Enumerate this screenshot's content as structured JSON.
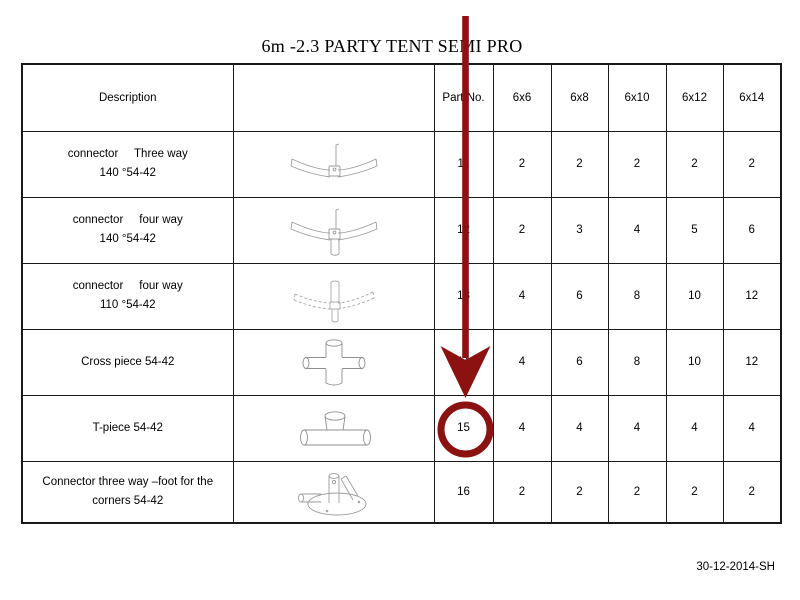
{
  "page": {
    "title": "6m -2.3 PARTY TENT SEMI PRO",
    "footer_code": "30-12-2014-SH"
  },
  "annotation": {
    "arrow_color": "#8c1212",
    "arrow_target": "Part No. column",
    "circled_value": "15"
  },
  "table": {
    "headers": {
      "description": "Description",
      "image": "",
      "part_no": "Part No.",
      "sizes": [
        "6x6",
        "6x8",
        "6x10",
        "6x12",
        "6x14"
      ]
    },
    "rows": [
      {
        "description_line1": "connector     Three way",
        "description_line2": "140 °54-42",
        "image_name": "three-way-connector-140-icon",
        "part_no": "11",
        "quantities": [
          "2",
          "2",
          "2",
          "2",
          "2"
        ]
      },
      {
        "description_line1": "connector     four way",
        "description_line2": "140 °54-42",
        "image_name": "four-way-connector-140-icon",
        "part_no": "12",
        "quantities": [
          "2",
          "3",
          "4",
          "5",
          "6"
        ]
      },
      {
        "description_line1": "connector     four way",
        "description_line2": "110 °54-42",
        "image_name": "four-way-connector-110-icon",
        "part_no": "13",
        "quantities": [
          "4",
          "6",
          "8",
          "10",
          "12"
        ]
      },
      {
        "description_line1": "Cross piece 54-42",
        "description_line2": "",
        "image_name": "cross-piece-icon",
        "part_no": "14",
        "quantities": [
          "4",
          "6",
          "8",
          "10",
          "12"
        ]
      },
      {
        "description_line1": "T-piece 54-42",
        "description_line2": "",
        "image_name": "t-piece-icon",
        "part_no": "15",
        "quantities": [
          "4",
          "4",
          "4",
          "4",
          "4"
        ]
      },
      {
        "description_line1": "Connector three way –foot for the",
        "description_line2": "corners 54-42",
        "image_name": "corner-foot-connector-icon",
        "part_no": "16",
        "quantities": [
          "2",
          "2",
          "2",
          "2",
          "2"
        ]
      }
    ]
  }
}
